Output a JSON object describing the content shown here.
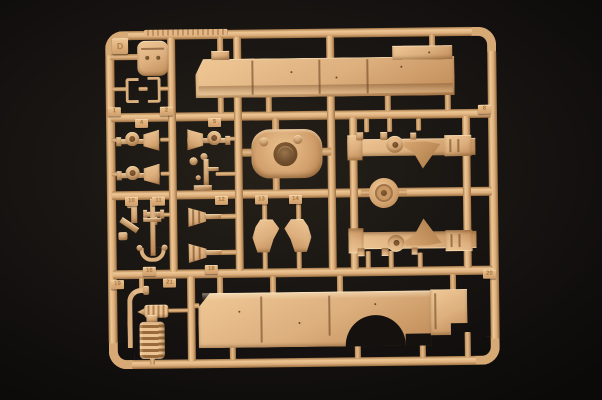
{
  "scene": {
    "description": "Photograph of a sand-colored plastic model kit sprue (parts tree) on a black studio background",
    "background_color": "#13110f",
    "plastic_color": "#dcae7c",
    "plastic_highlight": "#f0cb97",
    "plastic_shadow": "#9c7248"
  },
  "sprue": {
    "letter_tag": "D",
    "number_tags": [
      {
        "label": "1",
        "x": 109,
        "y": 105
      },
      {
        "label": "2",
        "x": 161,
        "y": 105
      },
      {
        "label": "4",
        "x": 136,
        "y": 117
      },
      {
        "label": "5",
        "x": 209,
        "y": 117
      },
      {
        "label": "8",
        "x": 479,
        "y": 107
      },
      {
        "label": "10",
        "x": 125,
        "y": 195
      },
      {
        "label": "11",
        "x": 152,
        "y": 195
      },
      {
        "label": "12",
        "x": 215,
        "y": 195
      },
      {
        "label": "13",
        "x": 255,
        "y": 195
      },
      {
        "label": "14",
        "x": 289,
        "y": 195
      },
      {
        "label": "16",
        "x": 142,
        "y": 265
      },
      {
        "label": "18",
        "x": 204,
        "y": 264
      },
      {
        "label": "19",
        "x": 110,
        "y": 278
      },
      {
        "label": "21",
        "x": 162,
        "y": 277
      },
      {
        "label": "20",
        "x": 482,
        "y": 272
      }
    ]
  }
}
